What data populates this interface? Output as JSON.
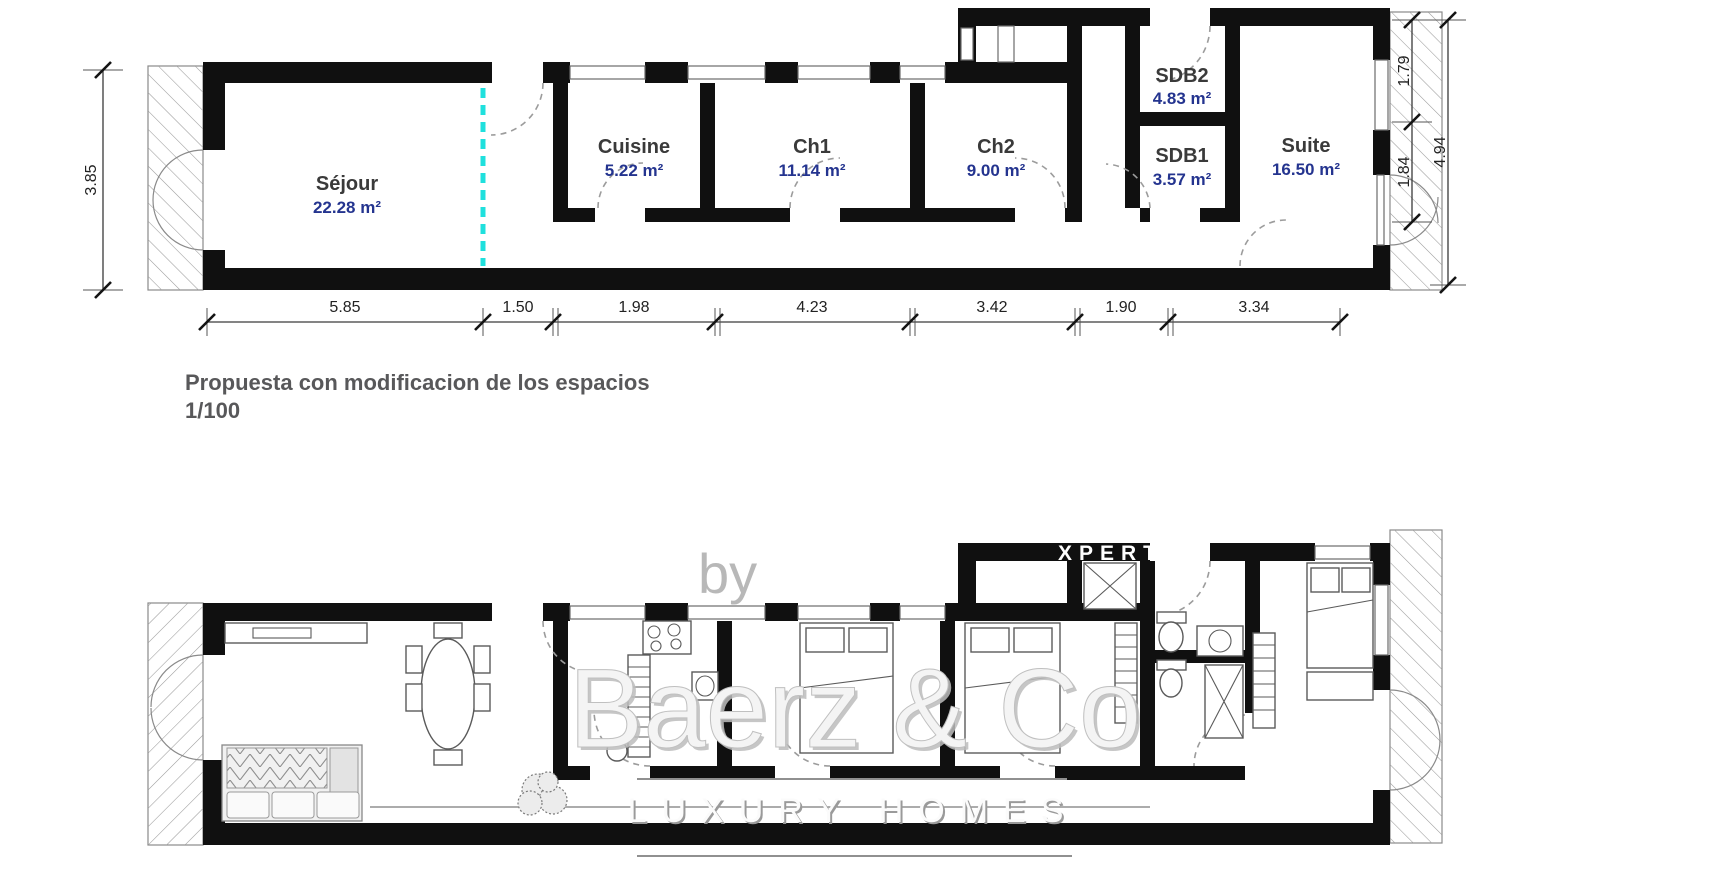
{
  "proposal_plan": {
    "caption_line1": "Propuesta con modificacion de los espacios",
    "caption_line2": "1/100",
    "rooms": [
      {
        "name": "Séjour",
        "area": "22.28 m²"
      },
      {
        "name": "Cuisine",
        "area": "5.22 m²"
      },
      {
        "name": "Ch1",
        "area": "11.14 m²"
      },
      {
        "name": "Ch2",
        "area": "9.00 m²"
      },
      {
        "name": "SDB2",
        "area": "4.83 m²"
      },
      {
        "name": "SDB1",
        "area": "3.57 m²"
      },
      {
        "name": "Suite",
        "area": "16.50 m²"
      }
    ],
    "width_dims": [
      "5.85",
      "1.50",
      "1.98",
      "4.23",
      "3.42",
      "1.90",
      "3.34"
    ],
    "left_height_dim": "3.85",
    "right_height_dims": [
      "1.79",
      "1.84",
      "4.94"
    ]
  },
  "watermark": {
    "prefix": "by",
    "partner": "XPERTS",
    "brand": "Baerz & Co",
    "tagline": "LUXURY HOMES"
  },
  "colors": {
    "wall": "#101010",
    "room_name": "#3a3a3a",
    "room_area": "#24348f",
    "divider_cyan": "#1fe0dd",
    "caption": "#58585a",
    "dim_text": "#222222",
    "watermark_gray": "#b8b8b8"
  }
}
